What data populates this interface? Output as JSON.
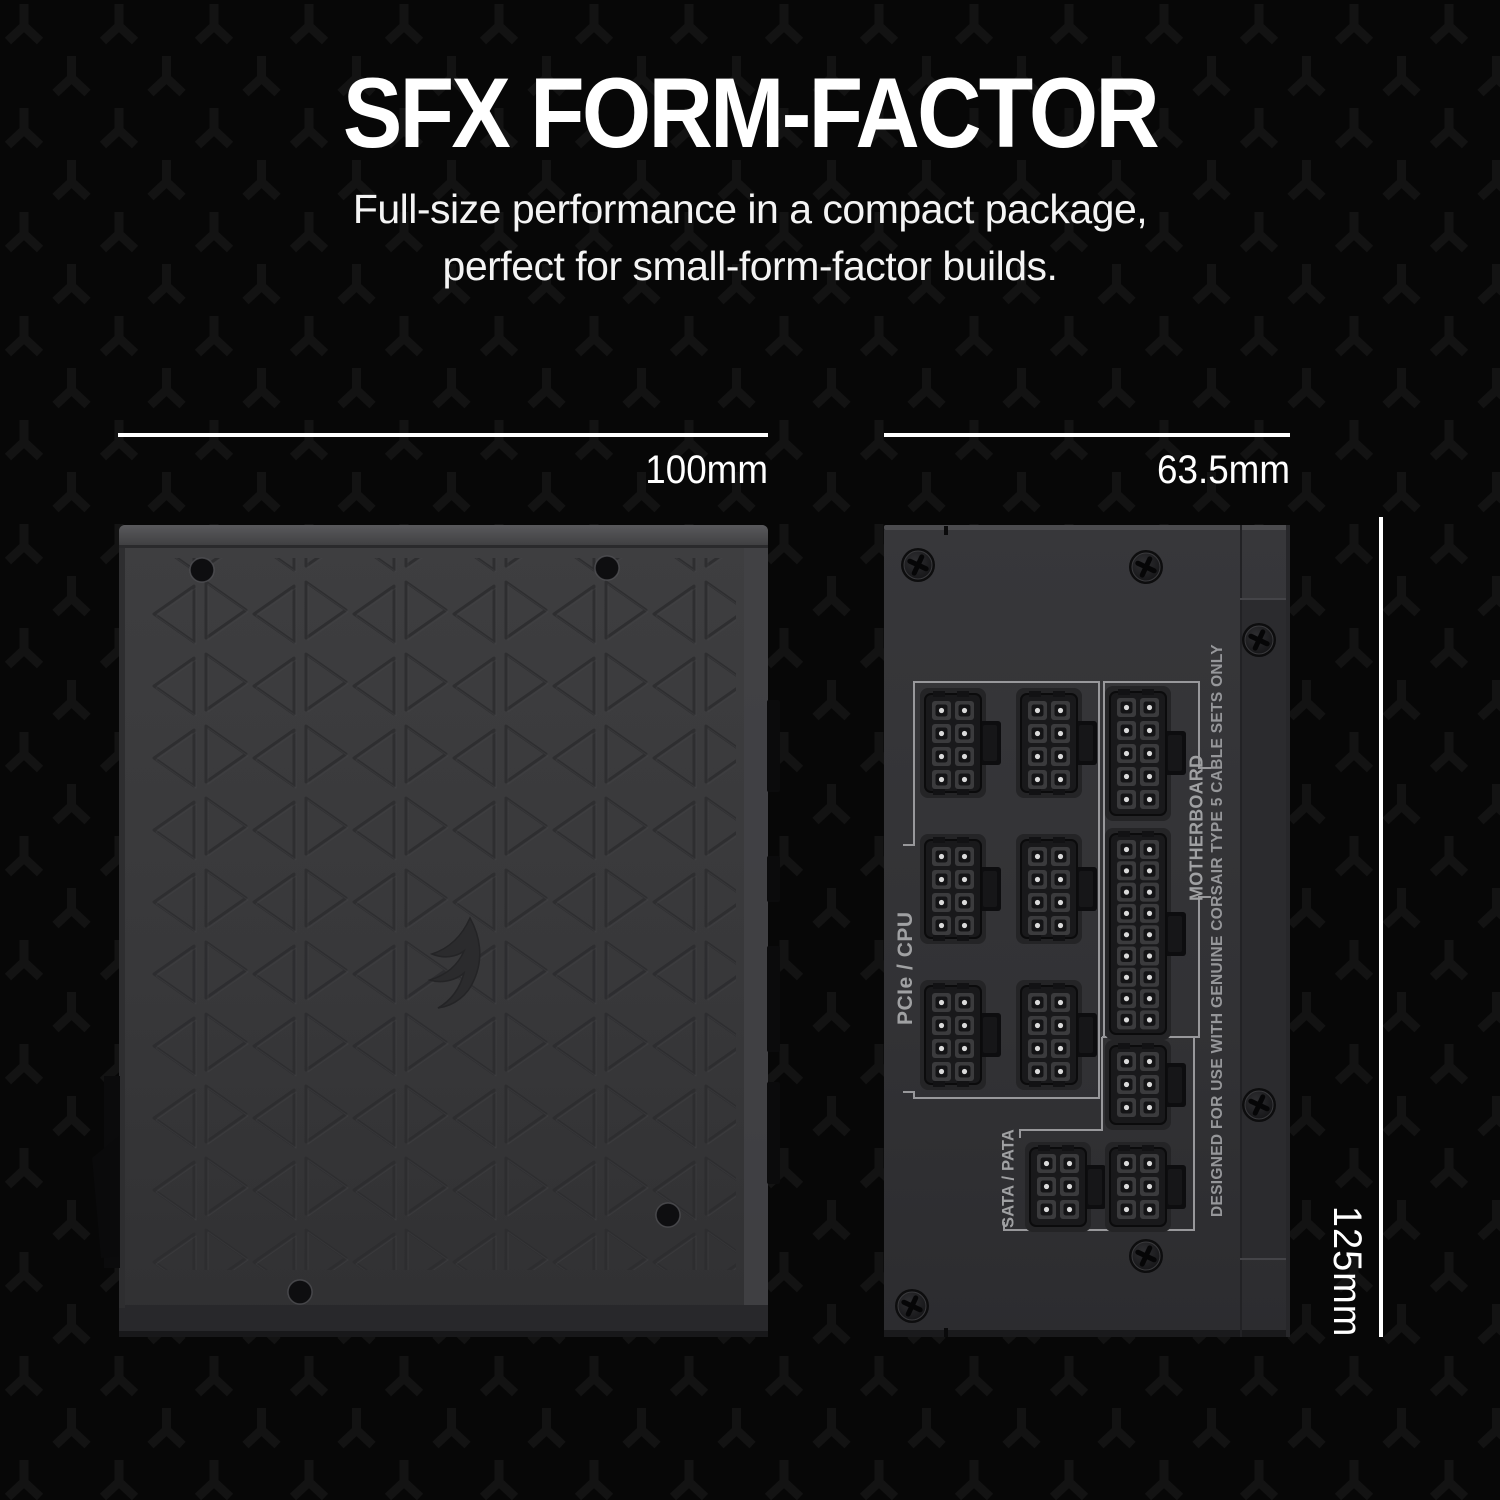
{
  "header": {
    "title": "SFX FORM-FACTOR",
    "subtitle_line1": "Full-size performance in a compact package,",
    "subtitle_line2": "perfect for small-form-factor builds."
  },
  "dimensions": {
    "width_label": "100mm",
    "depth_label": "63.5mm",
    "height_label": "125mm"
  },
  "connector_panel": {
    "group_pcie_cpu": "PCIe / CPU",
    "group_motherboard": "MOTHERBOARD",
    "group_sata_pata": "SATA / PATA",
    "warning": "DESIGNED FOR USE WITH GENUINE CORSAIR TYPE 5 CABLE SETS ONLY"
  },
  "colors": {
    "background": "#070707",
    "background_pattern": "#131313",
    "text_primary": "#ffffff",
    "label_gray": "#a0a1a3",
    "bracket_gray": "#98989b",
    "psu_body": "#3a3a3c",
    "panel_body": "#323234",
    "connector_black": "#1a1a1c"
  }
}
